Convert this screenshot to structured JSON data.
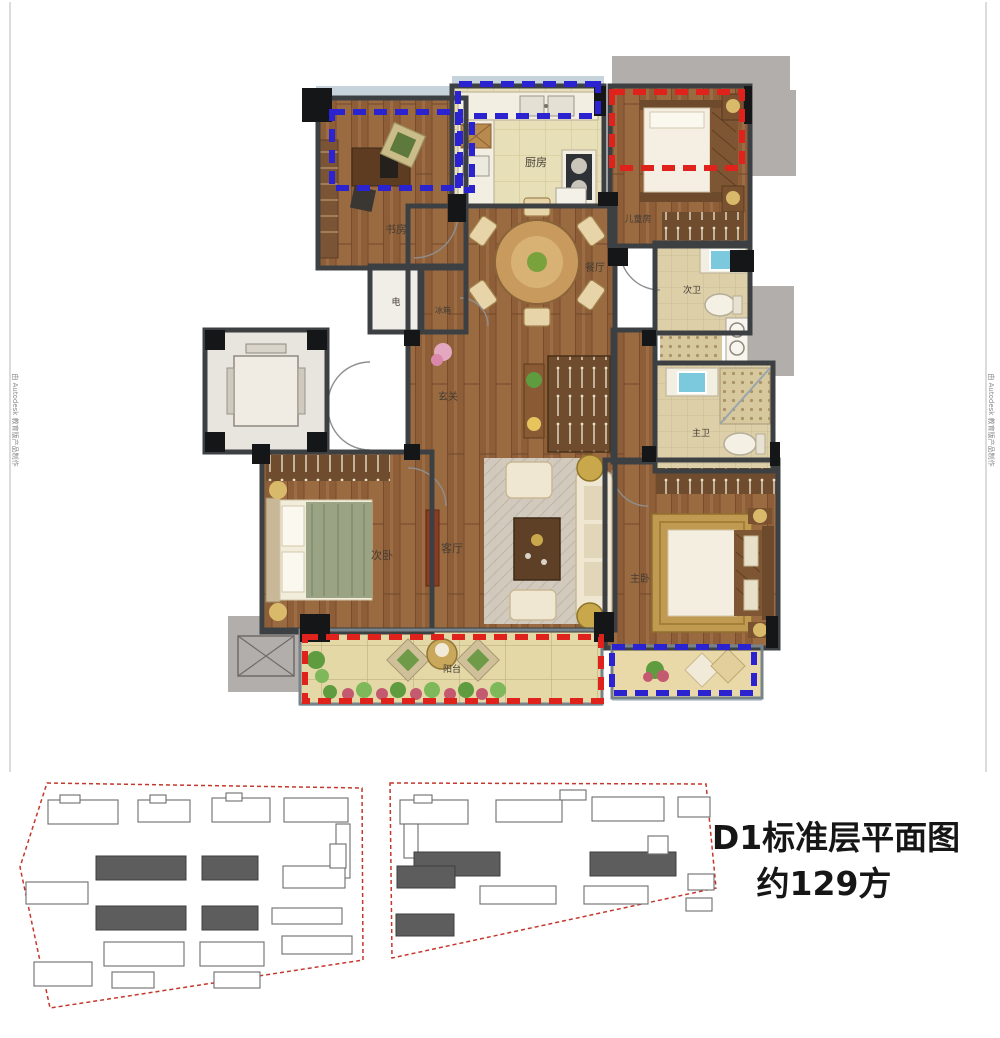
{
  "title": {
    "line1": "D1标准层平面图",
    "line2": "约129方"
  },
  "watermark": {
    "text": "由 Autodesk 教育版产品制作"
  },
  "floorplan": {
    "rooms": {
      "study": "书房",
      "kitchen": "厨房",
      "kids": "儿童房",
      "dining": "餐厅",
      "elec": "电",
      "fridge": "冰箱",
      "foyer": "玄关",
      "bath2": "次卫",
      "bath_master": "主卫",
      "bed2": "次卧",
      "living": "客厅",
      "bed_master": "主卧",
      "balcony": "阳台"
    }
  },
  "colors": {
    "wall": "#3d4043",
    "wood": "#9a6a41",
    "blue_dash": "#2a23cf",
    "red_dash": "#e0221c",
    "platform": "#b2aeab",
    "glass": "#c7d3da"
  }
}
